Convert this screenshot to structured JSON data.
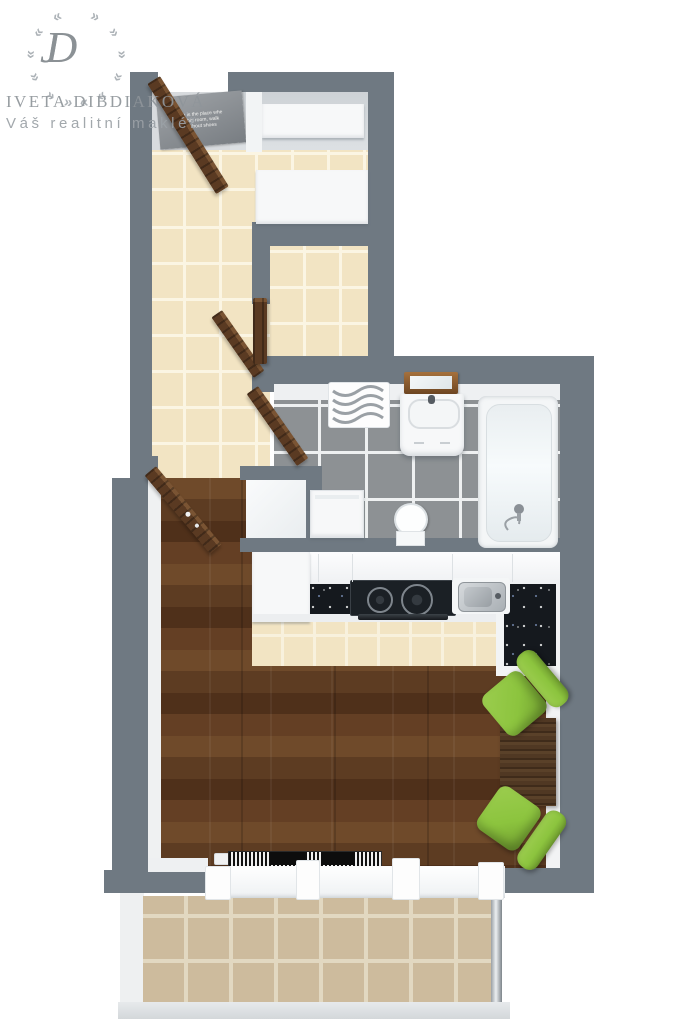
{
  "watermark": {
    "monogram": "JD",
    "name": "IVETA DIBDIAKOVÁ",
    "tagline": "Váš realitní makléř"
  },
  "doormat": {
    "lines": [
      "om is the place whe",
      "e big room, walk",
      "without shoes"
    ]
  },
  "palette": {
    "wall": "#6f7982",
    "hall_tile": "#f2e4c3",
    "hall_grout": "#fbf5e3",
    "strip_grout": "#f8f1dd",
    "bath_tile": "#8d9194",
    "bath_grout": "#eef0f1",
    "balcony_tile": "#cdbb9d",
    "balcony_grout": "#e2d8c1",
    "wood_base": "#5d3c22",
    "wood_light": "#6f4a2a",
    "wood_dark": "#4f301a",
    "door": "#5a3a22",
    "door_edge": "#7a5433",
    "counter": "#15191e",
    "cabinet": "#f7f8f9",
    "chair": "#8cc43e",
    "chair_light": "#9ccd4f",
    "chair_dark": "#6f9c2f",
    "table": "#46301f",
    "mat": "#8b9094",
    "closet_floor": "#d6dadd",
    "steel": "#b9bfc4",
    "white_face": "#f2f3f4"
  }
}
